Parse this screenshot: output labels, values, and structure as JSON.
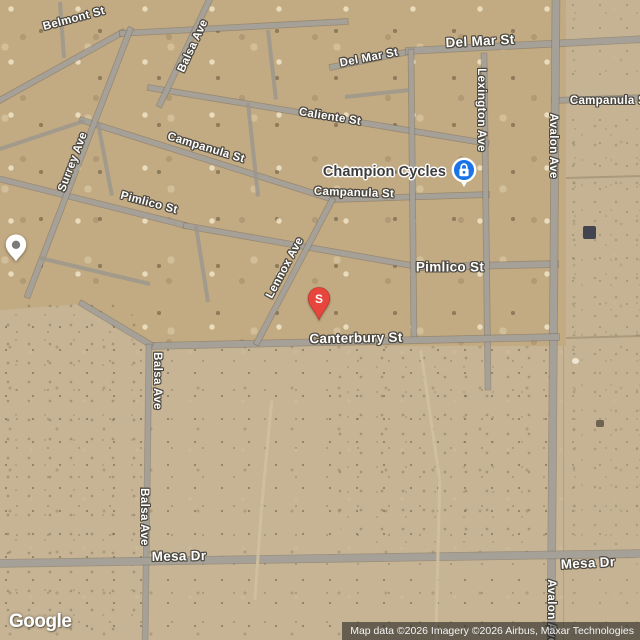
{
  "watermark": "Google",
  "attribution": "Map data ©2026 Imagery ©2026 Airbus, Maxar Technologies",
  "poi": {
    "label": "Champion Cycles",
    "marker_color": "#1A73E8"
  },
  "red_pin": {
    "label": "S",
    "color": "#E8453C"
  },
  "colors": {
    "road": "#a5a199",
    "desert": "#c7b495",
    "developed": "#c2aa83"
  },
  "street_labels": [
    {
      "text": "Belmont St",
      "x": 74,
      "y": 19,
      "rot": -15
    },
    {
      "text": "Balsa Ave",
      "x": 193,
      "y": 46,
      "rot": -65
    },
    {
      "text": "Del Mar St",
      "x": 369,
      "y": 58,
      "rot": -11
    },
    {
      "text": "Del Mar St",
      "x": 480,
      "y": 41,
      "rot": -3,
      "cls": "major"
    },
    {
      "text": "Caliente St",
      "x": 330,
      "y": 117,
      "rot": 9
    },
    {
      "text": "Campanula St",
      "x": 206,
      "y": 148,
      "rot": 17
    },
    {
      "text": "Campanula St",
      "x": 354,
      "y": 193,
      "rot": 2
    },
    {
      "text": "Campanula St",
      "x": 610,
      "y": 101,
      "rot": 0
    },
    {
      "text": "Lexington Ave",
      "x": 481,
      "y": 110,
      "cls": "vertical"
    },
    {
      "text": "Avalon Ave",
      "x": 553,
      "y": 146,
      "cls": "vertical"
    },
    {
      "text": "Surrey Ave",
      "x": 73,
      "y": 162,
      "rot": -69
    },
    {
      "text": "Pimlico St",
      "x": 149,
      "y": 203,
      "rot": 15
    },
    {
      "text": "Pimlico St",
      "x": 450,
      "y": 267,
      "rot": 0,
      "cls": "major"
    },
    {
      "text": "Lennox Ave",
      "x": 285,
      "y": 268,
      "rot": -62
    },
    {
      "text": "Canterbury St",
      "x": 356,
      "y": 338,
      "rot": -1,
      "cls": "major"
    },
    {
      "text": "Balsa Ave",
      "x": 157,
      "y": 381,
      "cls": "vertical"
    },
    {
      "text": "Balsa Ave",
      "x": 144,
      "y": 517,
      "cls": "vertical"
    },
    {
      "text": "Mesa Dr",
      "x": 179,
      "y": 556,
      "rot": -1,
      "cls": "major"
    },
    {
      "text": "Mesa Dr",
      "x": 588,
      "y": 563,
      "rot": -3,
      "cls": "major"
    },
    {
      "text": "Avalon Ave",
      "x": 551,
      "y": 612,
      "cls": "vertical"
    }
  ],
  "roads": [
    {
      "name": "belmont-west",
      "x1": -6,
      "y1": 103,
      "x2": 124,
      "y2": 31,
      "w": 5
    },
    {
      "name": "belmont-east",
      "x1": 120,
      "y1": 33,
      "x2": 348,
      "y2": 21,
      "w": 5
    },
    {
      "name": "del-mar-west",
      "x1": 330,
      "y1": 67,
      "x2": 410,
      "y2": 51,
      "w": 5
    },
    {
      "name": "del-mar-east",
      "x1": 406,
      "y1": 51,
      "x2": 646,
      "y2": 39,
      "w": 6
    },
    {
      "name": "caliente",
      "x1": 148,
      "y1": 87,
      "x2": 488,
      "y2": 143,
      "w": 5
    },
    {
      "name": "campanula-nw",
      "x1": 80,
      "y1": 119,
      "x2": 333,
      "y2": 199,
      "w": 5
    },
    {
      "name": "campanula-mid",
      "x1": 331,
      "y1": 199,
      "x2": 489,
      "y2": 194,
      "w": 5
    },
    {
      "name": "campanula-east",
      "x1": 552,
      "y1": 100,
      "x2": 646,
      "y2": 97,
      "w": 5
    },
    {
      "name": "pimlico-nw",
      "x1": -6,
      "y1": 177,
      "x2": 186,
      "y2": 225,
      "w": 5
    },
    {
      "name": "pimlico-mid",
      "x1": 184,
      "y1": 225,
      "x2": 423,
      "y2": 267,
      "w": 5
    },
    {
      "name": "pimlico-east",
      "x1": 421,
      "y1": 267,
      "x2": 558,
      "y2": 264,
      "w": 6
    },
    {
      "name": "surrey",
      "x1": 27,
      "y1": 297,
      "x2": 131,
      "y2": 27,
      "w": 5
    },
    {
      "name": "lexington",
      "x1": 484,
      "y1": 53,
      "x2": 488,
      "y2": 389,
      "w": 5
    },
    {
      "name": "north-south",
      "x1": 411,
      "y1": 49,
      "x2": 414,
      "y2": 341,
      "w": 5
    },
    {
      "name": "avalon",
      "x1": 556,
      "y1": -6,
      "x2": 551,
      "y2": 646,
      "w": 7
    },
    {
      "name": "canterbury",
      "x1": 148,
      "y1": 346,
      "x2": 559,
      "y2": 337,
      "w": 6
    },
    {
      "name": "balsa-diagonal",
      "x1": 80,
      "y1": 302,
      "x2": 152,
      "y2": 345,
      "w": 5
    },
    {
      "name": "balsa-south",
      "x1": 149,
      "y1": 344,
      "x2": 145,
      "y2": 646,
      "w": 5
    },
    {
      "name": "mesa",
      "x1": -6,
      "y1": 563,
      "x2": 646,
      "y2": 553,
      "w": 7
    },
    {
      "name": "balsa-north",
      "x1": 159,
      "y1": 106,
      "x2": 210,
      "y2": -2,
      "w": 5
    },
    {
      "name": "lennox",
      "x1": 256,
      "y1": 344,
      "x2": 333,
      "y2": 198,
      "w": 5
    },
    {
      "name": "minor-a",
      "x1": 0,
      "y1": 149,
      "x2": 84,
      "y2": 121,
      "w": 4,
      "cls": "minor"
    },
    {
      "name": "minor-b",
      "x1": 98,
      "y1": 123,
      "x2": 112,
      "y2": 196,
      "w": 4,
      "cls": "minor"
    },
    {
      "name": "minor-c",
      "x1": 248,
      "y1": 103,
      "x2": 258,
      "y2": 196,
      "w": 4,
      "cls": "minor"
    },
    {
      "name": "minor-d",
      "x1": 345,
      "y1": 97,
      "x2": 410,
      "y2": 90,
      "w": 4,
      "cls": "minor"
    },
    {
      "name": "minor-e",
      "x1": 40,
      "y1": 258,
      "x2": 150,
      "y2": 284,
      "w": 4,
      "cls": "minor"
    },
    {
      "name": "minor-f",
      "x1": 196,
      "y1": 226,
      "x2": 208,
      "y2": 302,
      "w": 4,
      "cls": "minor"
    },
    {
      "name": "minor-g",
      "x1": 60,
      "y1": 2,
      "x2": 64,
      "y2": 58,
      "w": 4,
      "cls": "minor"
    },
    {
      "name": "minor-h",
      "x1": 268,
      "y1": 30,
      "x2": 276,
      "y2": 100,
      "w": 4,
      "cls": "minor"
    },
    {
      "name": "trail-a",
      "x1": 272,
      "y1": 400,
      "x2": 262,
      "y2": 505,
      "w": 2.5,
      "cls": "trail"
    },
    {
      "name": "trail-b",
      "x1": 262,
      "y1": 505,
      "x2": 255,
      "y2": 600,
      "w": 2.5,
      "cls": "trail"
    },
    {
      "name": "trail-c",
      "x1": 421,
      "y1": 350,
      "x2": 440,
      "y2": 480,
      "w": 2.5,
      "cls": "trail"
    },
    {
      "name": "trail-d",
      "x1": 440,
      "y1": 480,
      "x2": 436,
      "y2": 646,
      "w": 2.5,
      "cls": "trail"
    },
    {
      "name": "parcel-line-a",
      "x1": 566,
      "y1": 178,
      "x2": 642,
      "y2": 176,
      "w": 1.5,
      "cls": "faint"
    },
    {
      "name": "parcel-line-b",
      "x1": 566,
      "y1": 338,
      "x2": 642,
      "y2": 336,
      "w": 1.5,
      "cls": "faint"
    }
  ]
}
